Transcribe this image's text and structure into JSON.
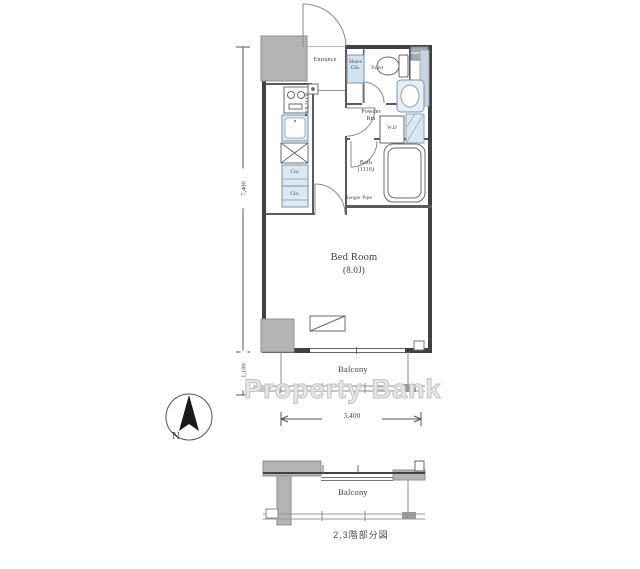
{
  "colors": {
    "wall": "#414141",
    "column_gray": "#b4b4b4",
    "fixture_blue": "#d9e8f2",
    "line_gray": "#888888",
    "watermark_gray": "#e6e6e6"
  },
  "floorplan": {
    "labels": {
      "entrance": "Entrance",
      "shoes_line1": "Shoes",
      "shoes_line2": "Clo.",
      "toilet": "Toilet",
      "powder_line1": "Powder",
      "powder_line2": "Rm",
      "washer": "W.D",
      "bath_line1": "Bath",
      "bath_line2": "(1116)",
      "hanger": "Hanger Pipe",
      "kitchen": "Kitchen",
      "closet_upper": "Clo.",
      "closet_lower": "Clo.",
      "bedroom_line1": "Bed Room",
      "bedroom_line2": "(8.0J)",
      "balcony": "Balcony"
    },
    "dimensions": {
      "width": "3,400",
      "main_height": "7,400",
      "balcony_height": "1,100"
    },
    "compass_label": "N",
    "watermark": "Property Bank",
    "subplan": {
      "balcony": "Balcony",
      "caption": "2,3階部分図"
    }
  }
}
